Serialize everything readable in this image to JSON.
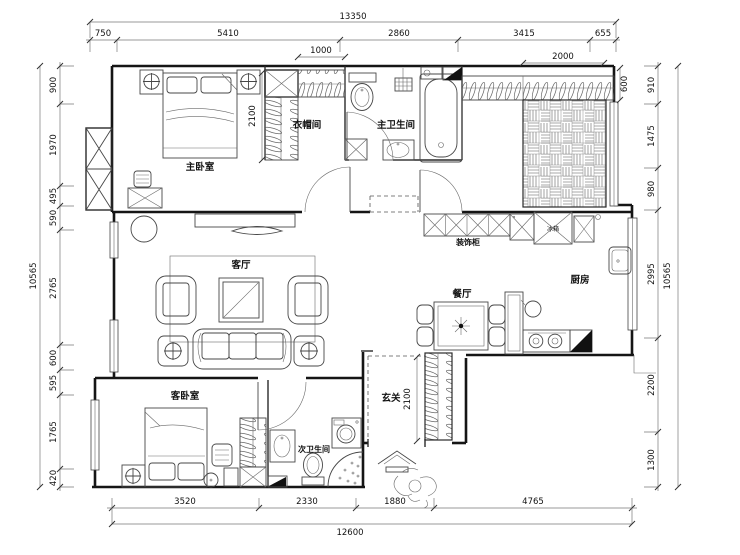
{
  "plan": {
    "rooms": {
      "master_bedroom": "主卧室",
      "cloakroom": "衣帽间",
      "master_bathroom": "主卫生间",
      "living_room": "客厅",
      "dining_room": "餐厅",
      "kitchen": "厨房",
      "entry": "玄关",
      "guest_bedroom": "客卧室",
      "second_bathroom": "次卫生间",
      "decorative_cabinet": "装饰柜",
      "fridge": "冰箱"
    },
    "dimensions": {
      "top": {
        "total": "13350",
        "segments": [
          "750",
          "5410",
          "2860",
          "3415",
          "655"
        ]
      },
      "bottom": {
        "total": "12600",
        "segments": [
          "3520",
          "2330",
          "1880",
          "4765"
        ]
      },
      "left": {
        "total": "10565",
        "segments": [
          "900",
          "1970",
          "495",
          "590",
          "2765",
          "600",
          "595",
          "1765",
          "420"
        ]
      },
      "right": {
        "total": "10565",
        "segments": [
          "910",
          "1475",
          "980",
          "2995",
          "2200",
          "1300"
        ]
      },
      "inner": {
        "cloakroom_width": "1000",
        "top_closet_width": "2000",
        "top_closet_depth": "600",
        "master_bed_width": "2100",
        "entry_depth": "2100"
      }
    }
  }
}
